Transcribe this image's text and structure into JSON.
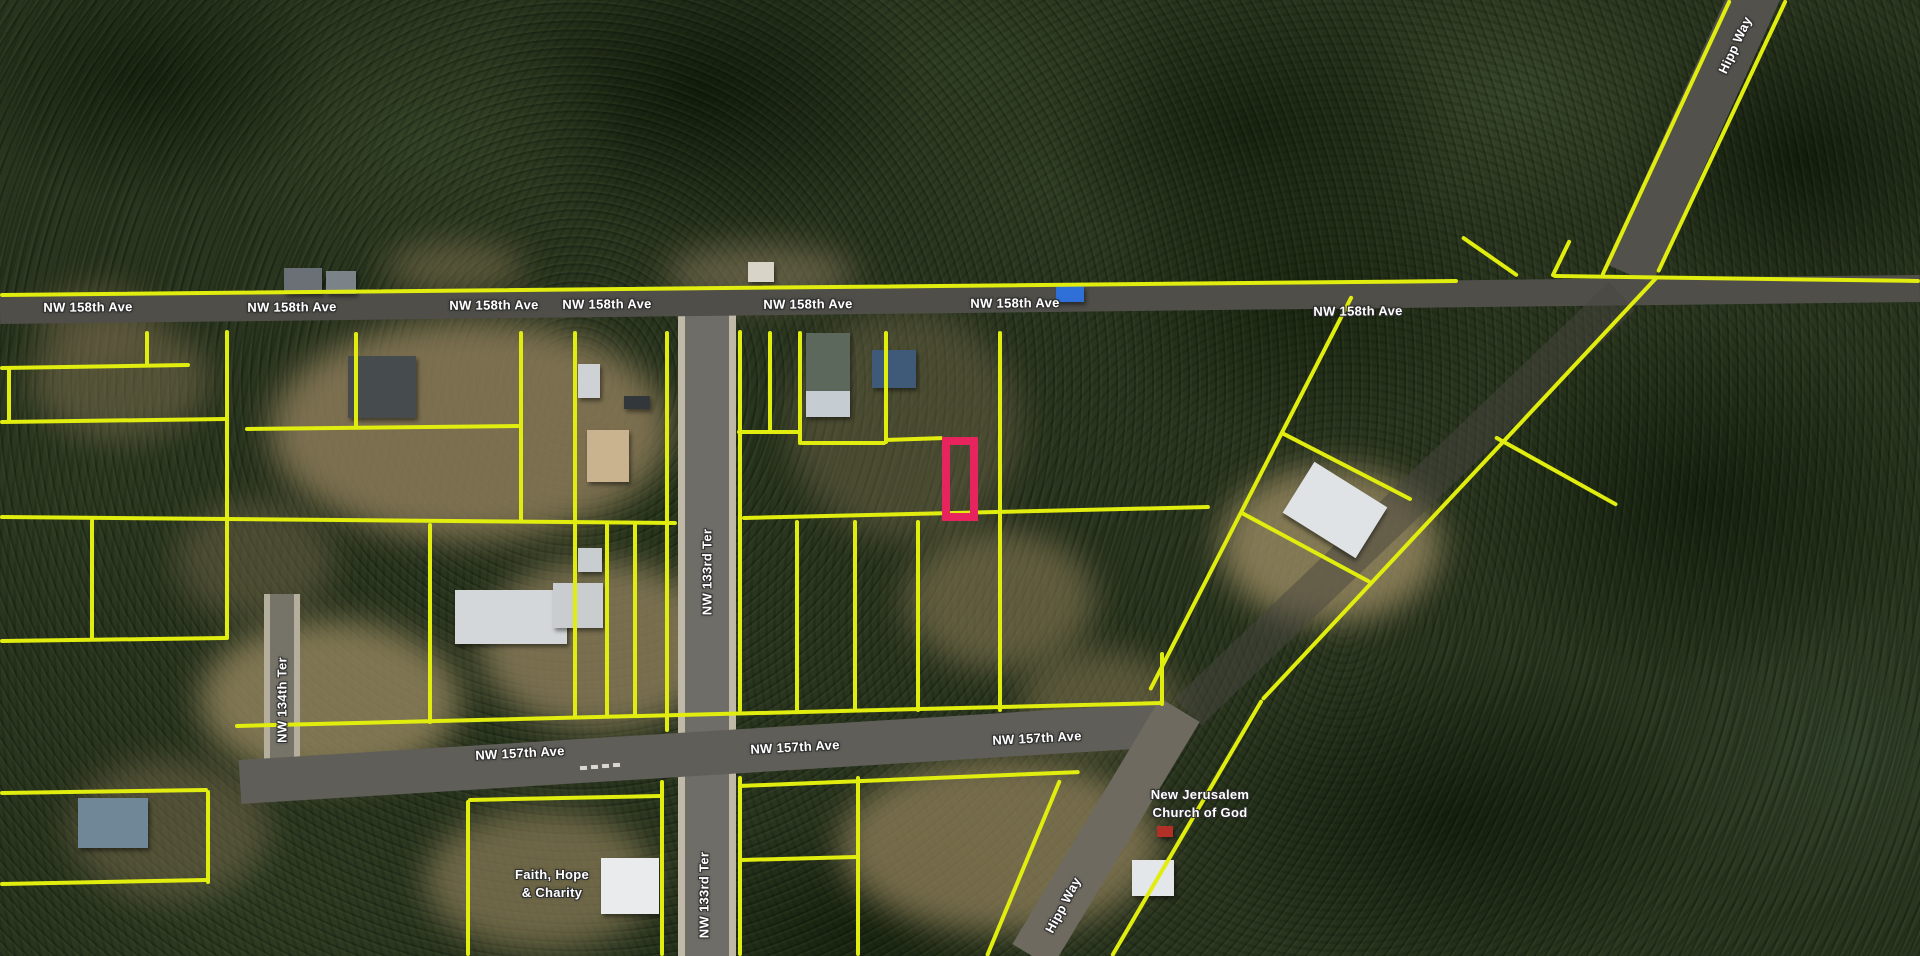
{
  "map": {
    "accent_parcel_color": "#e8245f",
    "parcel_line_color": "#e0ed0e",
    "parcel_line_width": 4,
    "selected_parcel": {
      "x": 942,
      "y": 437,
      "w": 36,
      "h": 84,
      "stroke": 8
    },
    "roads": [
      {
        "name": "nw-133rd-ter-base",
        "x1": 707,
        "y1": 312,
        "x2": 707,
        "y2": 956,
        "w": 58,
        "color": "#c0b9a8",
        "op": 1
      },
      {
        "name": "nw-133rd-ter-surface",
        "x1": 707,
        "y1": 312,
        "x2": 707,
        "y2": 956,
        "w": 44,
        "color": "#63625d",
        "op": 0.88
      },
      {
        "name": "nw-134th-ter-base",
        "x1": 282,
        "y1": 594,
        "x2": 282,
        "y2": 778,
        "w": 36,
        "color": "#b5ae9c",
        "op": 1
      },
      {
        "name": "nw-134th-ter-surface",
        "x1": 282,
        "y1": 594,
        "x2": 282,
        "y2": 778,
        "w": 24,
        "color": "#6b685f",
        "op": 0.85
      },
      {
        "name": "nw-158th-ave",
        "x1": 0,
        "y1": 310,
        "x2": 1920,
        "y2": 288,
        "w": 27,
        "color": "#4f4e49",
        "op": 1
      },
      {
        "name": "nw-157th-ave",
        "x1": 240,
        "y1": 782,
        "x2": 1165,
        "y2": 725,
        "w": 44,
        "color": "#5f5e58",
        "op": 1
      },
      {
        "name": "hipp-way-north",
        "x1": 1758,
        "y1": -12,
        "x2": 1629,
        "y2": 274,
        "w": 50,
        "color": "#52514c",
        "op": 1
      },
      {
        "name": "hipp-way-mid",
        "x1": 1622,
        "y1": 296,
        "x2": 1188,
        "y2": 712,
        "w": 38,
        "color": "#474540",
        "op": 0.5
      },
      {
        "name": "hipp-way-south",
        "x1": 1180,
        "y1": 710,
        "x2": 1032,
        "y2": 956,
        "w": 46,
        "color": "#6e6a60",
        "op": 1
      }
    ],
    "road_labels": [
      {
        "text": "NW 158th Ave",
        "x": 88,
        "y": 307,
        "rot": -0.5
      },
      {
        "text": "NW 158th Ave",
        "x": 292,
        "y": 307,
        "rot": -0.5
      },
      {
        "text": "NW 158th Ave",
        "x": 494,
        "y": 305,
        "rot": -0.5
      },
      {
        "text": "NW 158th Ave",
        "x": 607,
        "y": 304,
        "rot": -0.5
      },
      {
        "text": "NW 158th Ave",
        "x": 808,
        "y": 304,
        "rot": -0.5
      },
      {
        "text": "NW 158th Ave",
        "x": 1015,
        "y": 303,
        "rot": -0.5
      },
      {
        "text": "NW 158th Ave",
        "x": 1358,
        "y": 311,
        "rot": -0.5
      },
      {
        "text": "NW 157th Ave",
        "x": 520,
        "y": 753,
        "rot": -3
      },
      {
        "text": "NW 157th Ave",
        "x": 795,
        "y": 747,
        "rot": -3
      },
      {
        "text": "NW 157th Ave",
        "x": 1037,
        "y": 738,
        "rot": -3
      },
      {
        "text": "NW 133rd Ter",
        "x": 707,
        "y": 572,
        "rot": -90
      },
      {
        "text": "NW 133rd Ter",
        "x": 704,
        "y": 895,
        "rot": -90
      },
      {
        "text": "NW 134th Ter",
        "x": 282,
        "y": 700,
        "rot": -90
      },
      {
        "text": "Hipp Way",
        "x": 1735,
        "y": 45,
        "rot": -65
      },
      {
        "text": "Hipp Way",
        "x": 1063,
        "y": 905,
        "rot": -62
      }
    ],
    "place_labels": [
      {
        "line1": "New Jerusalem",
        "line2": "Church of God",
        "x": 1200,
        "y": 804
      },
      {
        "line1": "Faith, Hope",
        "line2": "& Charity",
        "x": 552,
        "y": 884
      }
    ],
    "parcel_segments": [
      [
        0,
        295,
        1458,
        281
      ],
      [
        1553,
        276,
        1920,
        281
      ],
      [
        1730,
        0,
        1602,
        276
      ],
      [
        1786,
        0,
        1658,
        272
      ],
      [
        1462,
        237,
        1518,
        276
      ],
      [
        1570,
        240,
        1552,
        277
      ],
      [
        0,
        517,
        677,
        523
      ],
      [
        227,
        330,
        227,
        640
      ],
      [
        0,
        641,
        227,
        638
      ],
      [
        0,
        368,
        190,
        365
      ],
      [
        147,
        331,
        147,
        367
      ],
      [
        9,
        368,
        9,
        422
      ],
      [
        0,
        422,
        227,
        419
      ],
      [
        92,
        517,
        92,
        641
      ],
      [
        245,
        429,
        520,
        426
      ],
      [
        356,
        332,
        356,
        428
      ],
      [
        521,
        331,
        521,
        522
      ],
      [
        575,
        331,
        575,
        522
      ],
      [
        575,
        523,
        575,
        718
      ],
      [
        607,
        523,
        607,
        718
      ],
      [
        635,
        523,
        635,
        718
      ],
      [
        667,
        331,
        667,
        732
      ],
      [
        662,
        780,
        662,
        956
      ],
      [
        740,
        330,
        740,
        712
      ],
      [
        740,
        776,
        740,
        956
      ],
      [
        742,
        518,
        1210,
        507
      ],
      [
        770,
        331,
        770,
        433
      ],
      [
        800,
        331,
        800,
        445
      ],
      [
        737,
        432,
        800,
        432
      ],
      [
        800,
        443,
        886,
        443
      ],
      [
        886,
        440,
        943,
        438
      ],
      [
        886,
        331,
        886,
        444
      ],
      [
        1000,
        331,
        1000,
        712
      ],
      [
        797,
        520,
        797,
        712
      ],
      [
        855,
        520,
        855,
        712
      ],
      [
        918,
        520,
        918,
        712
      ],
      [
        1162,
        652,
        1162,
        706
      ],
      [
        235,
        726,
        1163,
        703
      ],
      [
        1352,
        296,
        1150,
        690
      ],
      [
        1282,
        433,
        1412,
        500
      ],
      [
        1240,
        512,
        1370,
        582
      ],
      [
        1658,
        276,
        1262,
        700
      ],
      [
        1262,
        700,
        1112,
        956
      ],
      [
        1495,
        437,
        1617,
        505
      ],
      [
        430,
        523,
        430,
        724
      ],
      [
        0,
        793,
        208,
        790
      ],
      [
        208,
        790,
        208,
        884
      ],
      [
        0,
        884,
        208,
        880
      ],
      [
        468,
        800,
        662,
        796
      ],
      [
        468,
        800,
        468,
        956
      ],
      [
        740,
        860,
        858,
        857
      ],
      [
        858,
        776,
        858,
        956
      ],
      [
        740,
        786,
        1080,
        772
      ],
      [
        1060,
        780,
        987,
        956
      ]
    ],
    "buildings": [
      [
        587,
        430,
        42,
        52,
        0,
        "#c9b38f"
      ],
      [
        578,
        364,
        22,
        34,
        0,
        "#cfd2d4"
      ],
      [
        806,
        333,
        44,
        58,
        0,
        "#5c685c"
      ],
      [
        806,
        391,
        44,
        26,
        0,
        "#c6cdd2"
      ],
      [
        348,
        356,
        68,
        62,
        0,
        "#464b4e"
      ],
      [
        284,
        268,
        38,
        26,
        0,
        "#6a7076"
      ],
      [
        326,
        271,
        30,
        23,
        0,
        "#7b8288"
      ],
      [
        455,
        590,
        112,
        54,
        0,
        "#d4d7d9"
      ],
      [
        553,
        583,
        50,
        45,
        0,
        "#c9cdd0"
      ],
      [
        1292,
        480,
        86,
        60,
        32,
        "#dfe3e6"
      ],
      [
        601,
        858,
        58,
        56,
        0,
        "#e9ebec"
      ],
      [
        1132,
        860,
        42,
        36,
        0,
        "#e4e7ea"
      ],
      [
        1157,
        826,
        16,
        11,
        0,
        "#b23028"
      ],
      [
        78,
        798,
        70,
        50,
        0,
        "#6f8796"
      ],
      [
        1056,
        286,
        28,
        16,
        0,
        "#2f6fd8"
      ],
      [
        872,
        350,
        44,
        38,
        0,
        "#3f5a78"
      ],
      [
        748,
        262,
        26,
        20,
        0,
        "#d8d4c8"
      ],
      [
        624,
        396,
        26,
        13,
        0,
        "#32373c"
      ],
      [
        578,
        548,
        24,
        24,
        0,
        "#c8cdcf"
      ]
    ],
    "clearings": [
      [
        470,
        430,
        200,
        110,
        "#8a7a58",
        0.85
      ],
      [
        600,
        645,
        120,
        85,
        "#8d7e5c",
        0.8
      ],
      [
        905,
        425,
        115,
        115,
        "#7c6f50",
        0.4
      ],
      [
        1330,
        545,
        110,
        78,
        "#9a8a62",
        0.8
      ],
      [
        1000,
        600,
        95,
        70,
        "#8d7d58",
        0.55
      ],
      [
        330,
        700,
        130,
        80,
        "#95865f",
        0.8
      ],
      [
        1000,
        845,
        160,
        88,
        "#8f7f5a",
        0.75
      ],
      [
        120,
        380,
        90,
        60,
        "#7e7050",
        0.5
      ],
      [
        540,
        880,
        115,
        70,
        "#8a7c58",
        0.7
      ],
      [
        760,
        275,
        95,
        30,
        "#84775a",
        0.6
      ],
      [
        455,
        268,
        70,
        26,
        "#7f724f",
        0.55
      ],
      [
        1100,
        700,
        80,
        50,
        "#8a7a55",
        0.5
      ],
      [
        170,
        830,
        100,
        70,
        "#7a6c4e",
        0.5
      ],
      [
        255,
        560,
        80,
        60,
        "#75694c",
        0.45
      ],
      [
        95,
        320,
        60,
        35,
        "#77694b",
        0.4
      ]
    ],
    "crosswalk_dashes": [
      [
        580,
        766
      ],
      [
        591,
        765
      ],
      [
        602,
        764
      ],
      [
        613,
        763
      ]
    ]
  }
}
